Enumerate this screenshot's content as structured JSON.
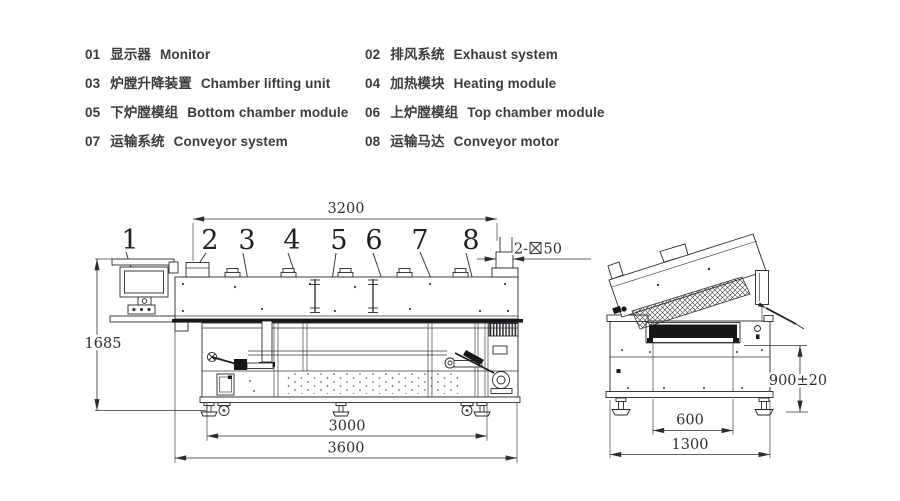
{
  "legend": {
    "items": [
      {
        "num": "01",
        "zh": "显示器",
        "en": "Monitor"
      },
      {
        "num": "02",
        "zh": "排风系统",
        "en": "Exhaust system"
      },
      {
        "num": "03",
        "zh": "炉膛升降装置",
        "en": "Chamber lifting unit"
      },
      {
        "num": "04",
        "zh": "加热模块",
        "en": "Heating module"
      },
      {
        "num": "05",
        "zh": "下炉膛模组",
        "en": "Bottom chamber module"
      },
      {
        "num": "06",
        "zh": "上炉膛模组",
        "en": "Top chamber module"
      },
      {
        "num": "07",
        "zh": "运输系统",
        "en": "Conveyor system"
      },
      {
        "num": "08",
        "zh": "运输马达",
        "en": "Conveyor motor"
      }
    ]
  },
  "callouts": [
    "1",
    "2",
    "3",
    "4",
    "5",
    "6",
    "7",
    "8"
  ],
  "dims": {
    "side": {
      "top": "3200",
      "height": "1685",
      "inner": "3000",
      "total": "3600",
      "duct_prefix": "2-",
      "duct_size": "50"
    },
    "end": {
      "height": "900±20",
      "inner": "600",
      "total": "1300"
    }
  },
  "colors": {
    "ink": "#27272c",
    "text": "#3b3b3b",
    "background": "#ffffff"
  }
}
